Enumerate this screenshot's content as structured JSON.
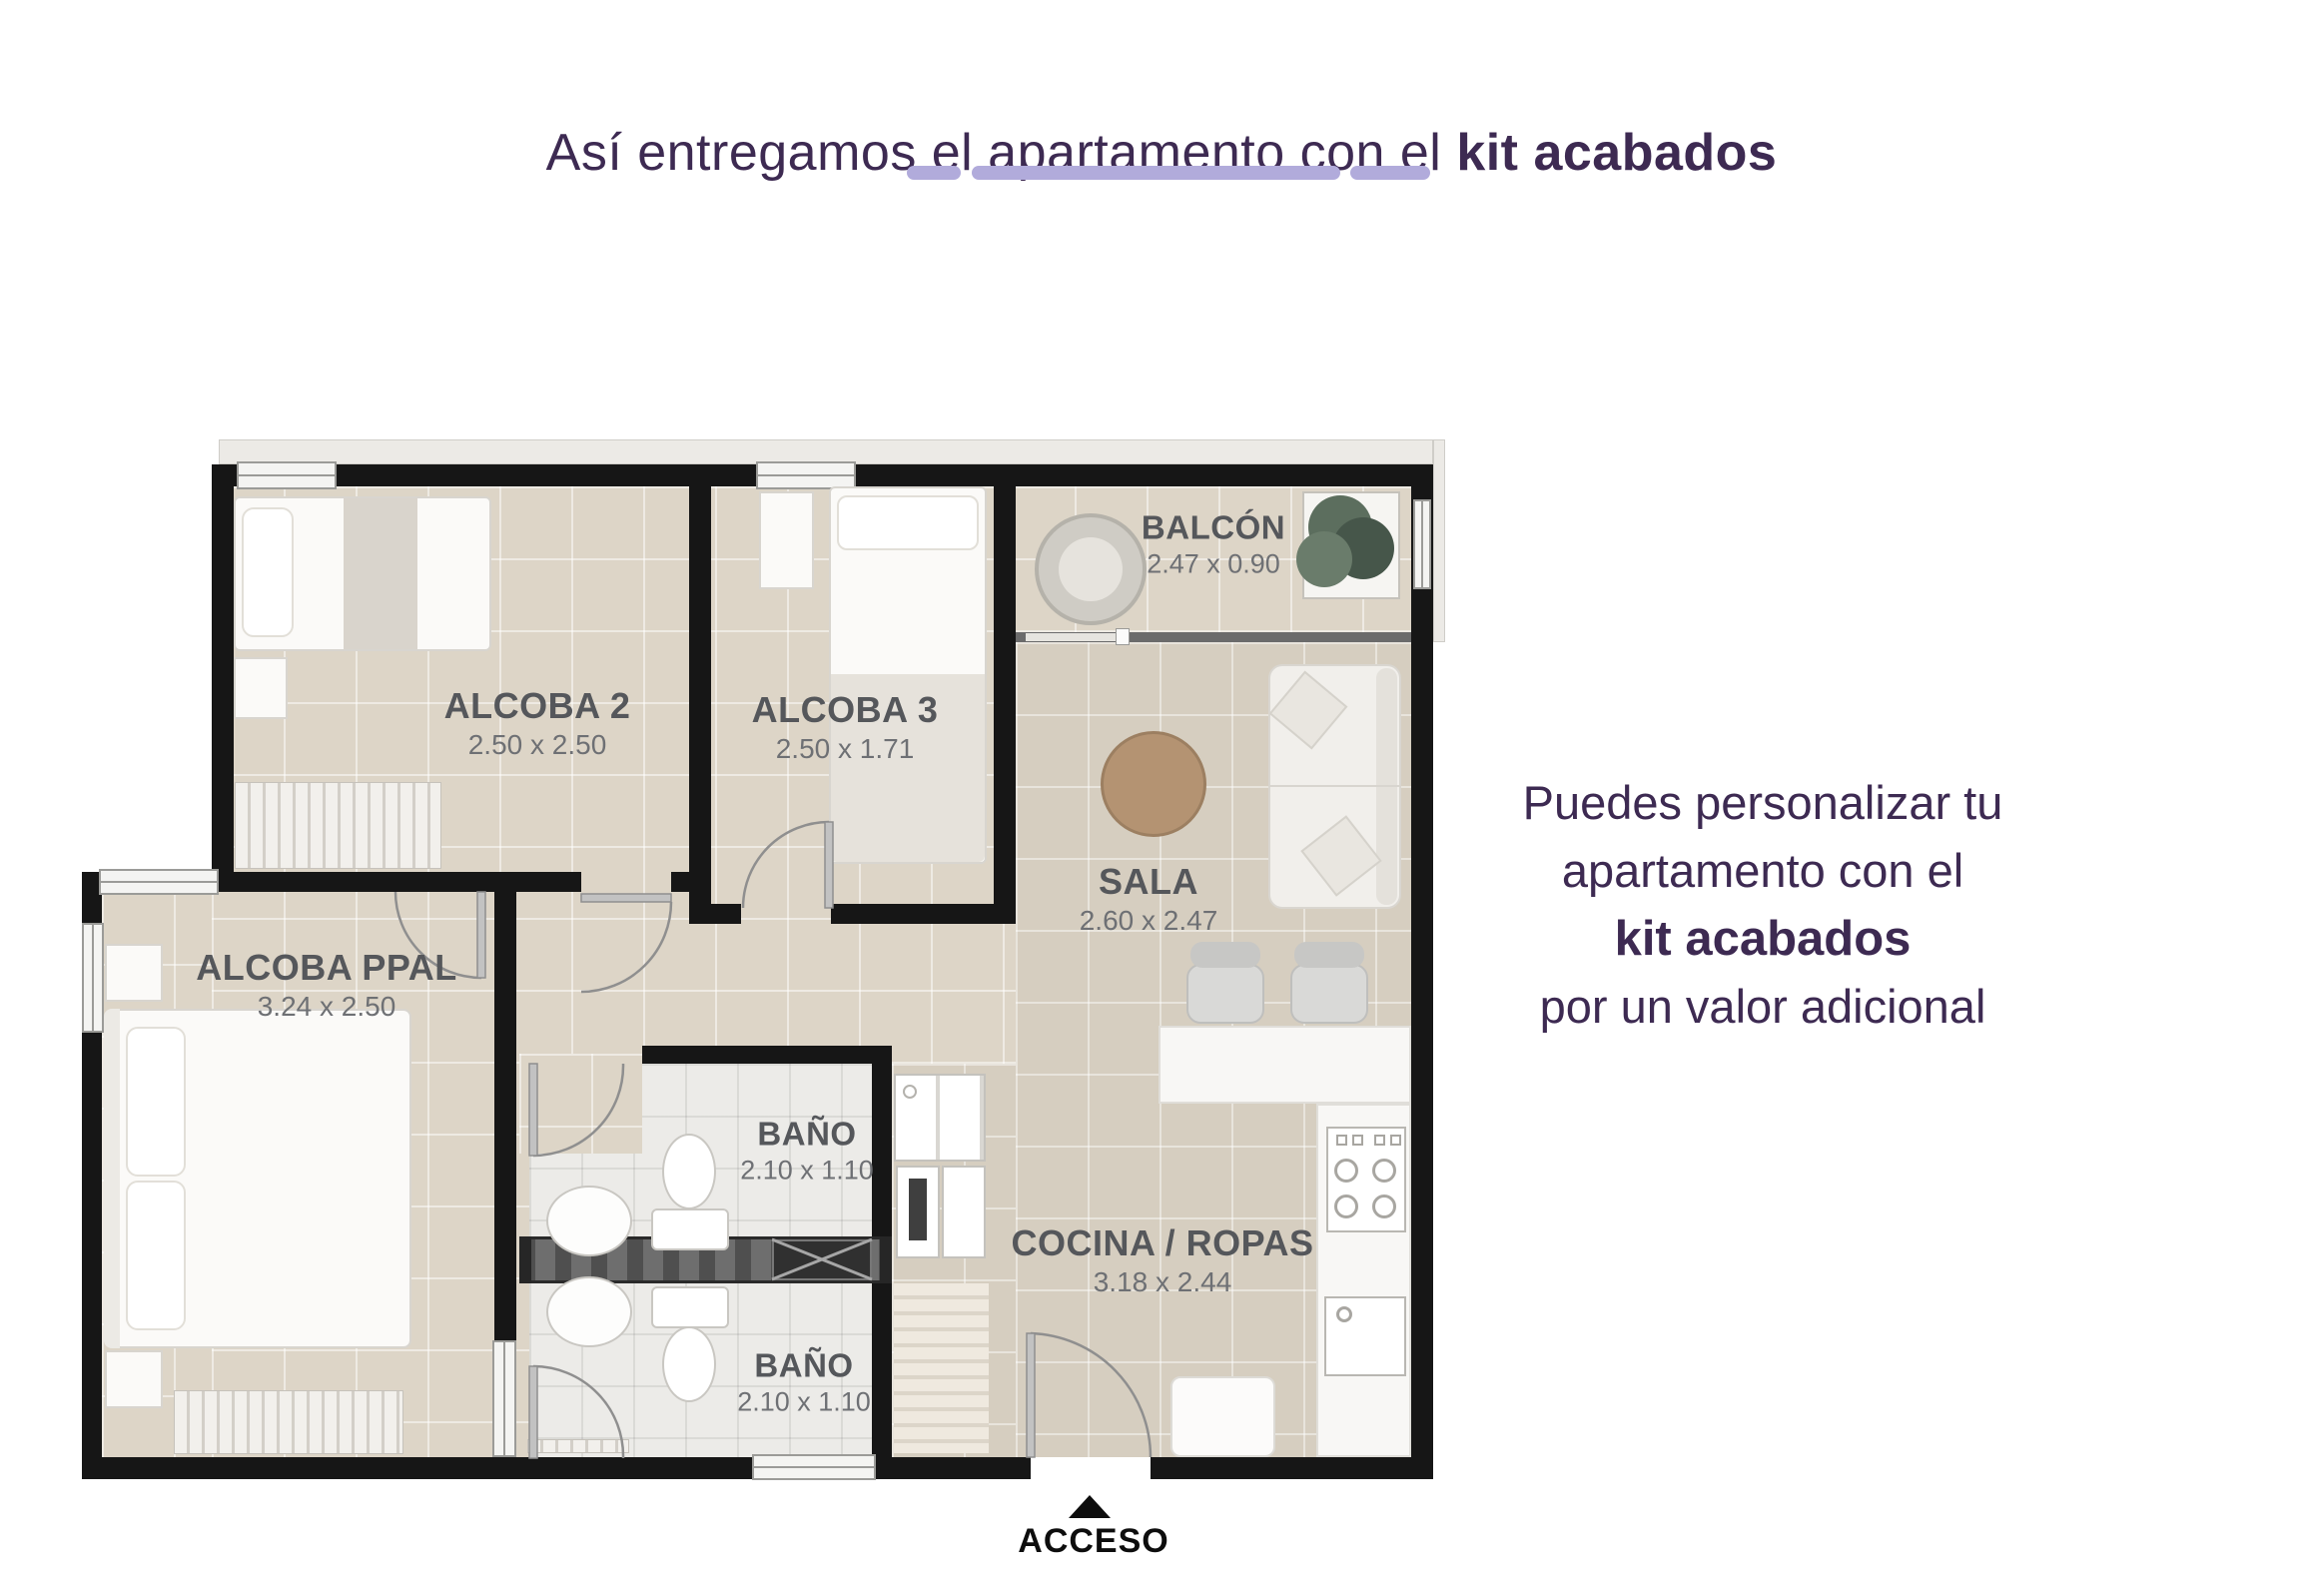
{
  "title": {
    "prefix": "Así entregamos el apartamento con el ",
    "bold": "kit acabados"
  },
  "side_note": {
    "lines": [
      "Puedes personalizar tu",
      "apartamento con el",
      "kit acabados",
      "por un valor adicional"
    ]
  },
  "access": {
    "label": "ACCESO",
    "icon": "up-triangle"
  },
  "rooms": [
    {
      "name": "ALCOBA 2",
      "dims": "2.50 x 2.50"
    },
    {
      "name": "ALCOBA 3",
      "dims": "2.50 x 1.71"
    },
    {
      "name": "BALCÓN",
      "dims": "2.47 x 0.90"
    },
    {
      "name": "SALA",
      "dims": "2.60 x 2.47"
    },
    {
      "name": "ALCOBA PPAL",
      "dims": "3.24 x 2.50"
    },
    {
      "name": "BAÑO",
      "dims": "2.10 x 1.10"
    },
    {
      "name": "BAÑO",
      "dims": "2.10 x 1.10"
    },
    {
      "name": "COCINA / ROPAS",
      "dims": "3.18 x 2.44"
    }
  ],
  "colors": {
    "accent_purple": "#3d2a52",
    "lavender": "#b1abdb",
    "wall": "#161616",
    "floor_beige": "#ddd5c7",
    "floor_taupe": "#d6cec0",
    "bath_tile": "#ecebe8",
    "label_gray": "#55575b"
  }
}
